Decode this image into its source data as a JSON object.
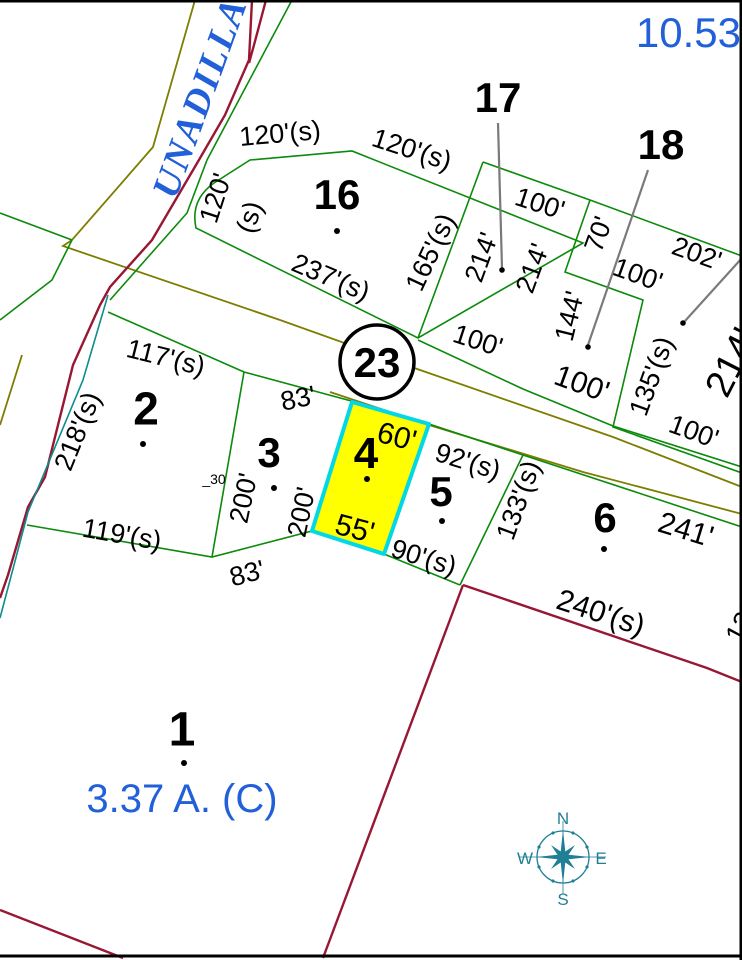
{
  "colors": {
    "parcel_line": "#0b8a0b",
    "road_line": "#7d7d00",
    "boundary_line": "#981733",
    "water_line": "#0d8d8d",
    "leader_line": "#7a7a7a",
    "highlight_fill": "#ffff00",
    "highlight_stroke": "#00d8e8",
    "annotation_blue": "#2160d9",
    "compass_teal": "#1f7f96",
    "label_black": "#000000"
  },
  "annotations": {
    "street_name": "UNADILLA",
    "block_area": "10.53",
    "road_badge": "23",
    "lot1_area": "3.37 A. (C)",
    "small_note": "_30"
  },
  "compass": {
    "north": "N",
    "east": "E",
    "south": "S",
    "west": "W"
  },
  "parcels": [
    {
      "number": "1",
      "x": 182,
      "y": 728,
      "size": 48,
      "dot": [
        184,
        763
      ]
    },
    {
      "number": "2",
      "x": 146,
      "y": 408,
      "size": 46,
      "dot": [
        143,
        444
      ]
    },
    {
      "number": "3",
      "x": 269,
      "y": 452,
      "size": 42,
      "dot": [
        274,
        488
      ]
    },
    {
      "number": "4",
      "x": 366,
      "y": 452,
      "size": 44,
      "dot": [
        367,
        479
      ]
    },
    {
      "number": "5",
      "x": 441,
      "y": 491,
      "size": 42,
      "dot": [
        442,
        521
      ]
    },
    {
      "number": "6",
      "x": 605,
      "y": 517,
      "size": 42,
      "dot": [
        604,
        549
      ]
    },
    {
      "number": "16",
      "x": 337,
      "y": 194,
      "size": 42,
      "dot": [
        337,
        231
      ]
    },
    {
      "number": "17",
      "x": 498,
      "y": 97,
      "size": 42
    },
    {
      "number": "18",
      "x": 661,
      "y": 144,
      "size": 42
    }
  ],
  "leader_lines": [
    {
      "x1": 498,
      "y1": 123,
      "x2": 502,
      "y2": 268,
      "dot": [
        502,
        270
      ]
    },
    {
      "x1": 648,
      "y1": 170,
      "x2": 588,
      "y2": 345,
      "dot": [
        588,
        347
      ]
    },
    {
      "x1": 742,
      "y1": 258,
      "x2": 685,
      "y2": 321,
      "dot": [
        683,
        323
      ]
    }
  ],
  "dimension_labels": [
    {
      "text": "120'(s)",
      "x": 280,
      "y": 133,
      "rot": -5
    },
    {
      "text": "120'(s)",
      "x": 412,
      "y": 149,
      "rot": 18
    },
    {
      "text": "120'",
      "x": 215,
      "y": 198,
      "rot": -72
    },
    {
      "text": "(s)",
      "x": 249,
      "y": 217,
      "rot": -72
    },
    {
      "text": "237'(s)",
      "x": 331,
      "y": 277,
      "rot": 23
    },
    {
      "text": "165'(s)",
      "x": 430,
      "y": 252,
      "rot": -65
    },
    {
      "text": "100'",
      "x": 540,
      "y": 203,
      "rot": 18
    },
    {
      "text": "214'",
      "x": 481,
      "y": 257,
      "rot": -70
    },
    {
      "text": "214'",
      "x": 532,
      "y": 268,
      "rot": -70
    },
    {
      "text": "70'",
      "x": 598,
      "y": 234,
      "rot": -70
    },
    {
      "text": "100'",
      "x": 638,
      "y": 274,
      "rot": 20
    },
    {
      "text": "202'",
      "x": 697,
      "y": 253,
      "rot": 20
    },
    {
      "text": "144'",
      "x": 569,
      "y": 316,
      "rot": -76
    },
    {
      "text": "100'",
      "x": 582,
      "y": 383,
      "rot": 20,
      "size": 30
    },
    {
      "text": "135'(s)",
      "x": 651,
      "y": 376,
      "rot": -70
    },
    {
      "text": "100'",
      "x": 694,
      "y": 431,
      "rot": 20
    },
    {
      "text": "214'",
      "x": 731,
      "y": 362,
      "rot": -63,
      "size": 38
    },
    {
      "text": "100'",
      "x": 478,
      "y": 340,
      "rot": 18
    },
    {
      "text": "117'(s)",
      "x": 166,
      "y": 357,
      "rot": 14
    },
    {
      "text": "218'(s)",
      "x": 77,
      "y": 431,
      "rot": -68
    },
    {
      "text": "119'(s)",
      "x": 122,
      "y": 534,
      "rot": 10
    },
    {
      "text": "83'",
      "x": 298,
      "y": 398,
      "rot": -12
    },
    {
      "text": "200'",
      "x": 243,
      "y": 498,
      "rot": -78
    },
    {
      "text": "200'",
      "x": 301,
      "y": 512,
      "rot": -78
    },
    {
      "text": "83'",
      "x": 247,
      "y": 573,
      "rot": -15
    },
    {
      "text": "60'",
      "x": 397,
      "y": 436,
      "rot": 15,
      "size": 30
    },
    {
      "text": "55'",
      "x": 355,
      "y": 528,
      "rot": 15,
      "size": 30
    },
    {
      "text": "92'(s)",
      "x": 468,
      "y": 461,
      "rot": 17
    },
    {
      "text": "90'(s)",
      "x": 424,
      "y": 557,
      "rot": 17
    },
    {
      "text": "133'(s)",
      "x": 518,
      "y": 500,
      "rot": -70
    },
    {
      "text": "241'",
      "x": 686,
      "y": 529,
      "rot": 17,
      "size": 30
    },
    {
      "text": "240'(s)",
      "x": 601,
      "y": 612,
      "rot": 18,
      "size": 30
    },
    {
      "text": "135'",
      "x": 744,
      "y": 618,
      "rot": -62
    }
  ]
}
